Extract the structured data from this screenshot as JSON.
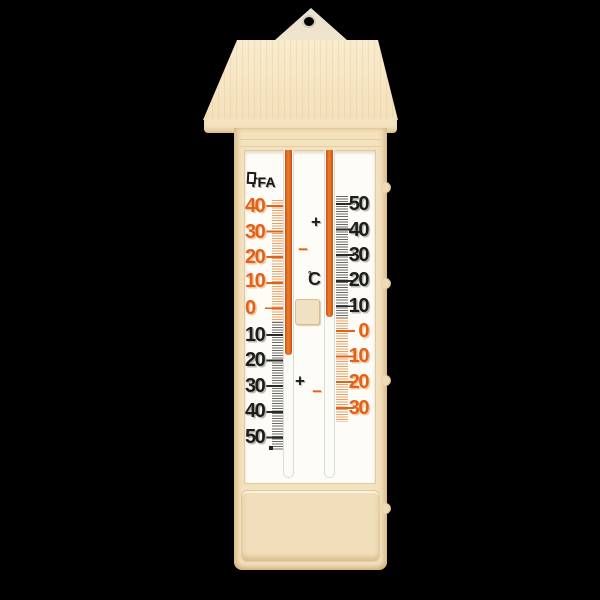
{
  "scene": {
    "background": "#000000",
    "subject": "analog min-max wall thermometer on black background"
  },
  "brand": {
    "name": "TFA"
  },
  "unit": {
    "degree": "°",
    "letter": "C"
  },
  "signs": {
    "upper_plus": "+",
    "upper_minus": "–",
    "lower_plus": "+",
    "lower_minus": "–"
  },
  "left_scale": {
    "role": "minimum scale, reads +40 at top down to -50 at bottom",
    "labels": [
      {
        "t": "40",
        "c": "orange",
        "y": 206
      },
      {
        "t": "30",
        "c": "orange",
        "y": 232
      },
      {
        "t": "20",
        "c": "orange",
        "y": 257
      },
      {
        "t": "10",
        "c": "orange",
        "y": 281
      },
      {
        "t": "0",
        "c": "orange",
        "y": 308
      },
      {
        "t": "10",
        "c": "black",
        "y": 335
      },
      {
        "t": "20",
        "c": "black",
        "y": 360
      },
      {
        "t": "30",
        "c": "black",
        "y": 386
      },
      {
        "t": "40",
        "c": "black",
        "y": 411
      },
      {
        "t": "50",
        "c": "black",
        "y": 437
      }
    ]
  },
  "right_scale": {
    "role": "maximum scale, reads +50 at top down to -30 at bottom",
    "labels": [
      {
        "t": "50",
        "c": "black",
        "y": 204
      },
      {
        "t": "40",
        "c": "black",
        "y": 230
      },
      {
        "t": "30",
        "c": "black",
        "y": 255
      },
      {
        "t": "20",
        "c": "black",
        "y": 280
      },
      {
        "t": "10",
        "c": "black",
        "y": 306
      },
      {
        "t": "0",
        "c": "orange",
        "y": 331
      },
      {
        "t": "10",
        "c": "orange",
        "y": 356
      },
      {
        "t": "20",
        "c": "orange",
        "y": 382
      },
      {
        "t": "30",
        "c": "orange",
        "y": 408
      }
    ]
  },
  "colors": {
    "orange": "#e2621c",
    "black_digit": "#1d1d1b",
    "body_cream": "#f4e1bd",
    "roof_cream": "#f6e8c8",
    "panel_white": "#fdfcf6",
    "bottom_panel": "#f1debb"
  }
}
